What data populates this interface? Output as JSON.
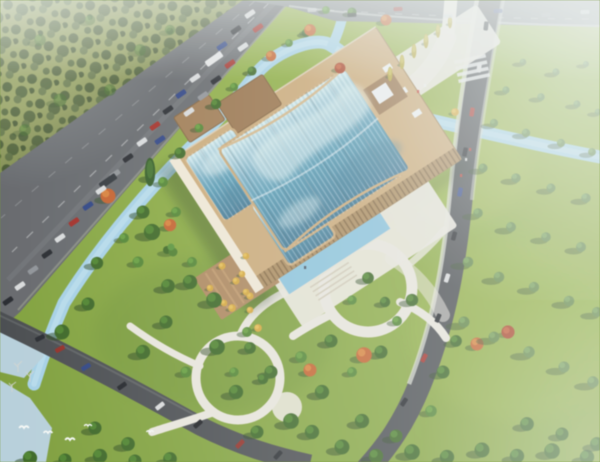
{
  "meta": {
    "type": "aerial-architectural-rendering",
    "subject": "Bird's-eye rendering of a cultural center with three curved glass vault roofs set in a landscaped riverside park",
    "time_of_day": "day",
    "season": "early autumn"
  },
  "palette": {
    "lawn": "#7a9a3a",
    "lawn_light": "#9ab64c",
    "forest_base": "#8f9b58",
    "forest_dot": "#46592f",
    "road": "#63666a",
    "road_dark": "#45484c",
    "road_haze": "#7e8386",
    "curb": "#9aa08f",
    "water": "#a6d0e4",
    "pond": "#b7cfd9",
    "pool": "#8cc2da",
    "path_light": "#e9e6dc",
    "plaza_tan": "#aa845c",
    "deck_brown": "#96714a",
    "frame_tan": "#c9a878",
    "wall_light": "#f0e8d6",
    "wall_shade": "#a98a5e",
    "glass_light": "#d6edf0",
    "glass_mid": "#7fb2c6",
    "glass_teal": "#579ab3",
    "glass_deep": "#3f7490",
    "tree_dark": "#386222",
    "tree_mid": "#4e8030",
    "tree_pale": "#5d8242",
    "autumn_orange": "#bf5f2c",
    "autumn_yellow": "#d2a53e",
    "autumn_red": "#a33d22",
    "car_white": "#d8dadb",
    "car_dark": "#23262b",
    "car_red": "#9c2b24",
    "car_blue": "#2b3f7e",
    "haze": "#eef3f2"
  },
  "scene": {
    "building": {
      "glass_halls": 3,
      "roof_style": "curved glass vaults with fine mullion stripes and wavy sky reflections",
      "frame": "tan stone podium with sunlit white west walls",
      "north_decks": "two brown entrance decks bridging the stream",
      "south": "reflecting pool, white plaza with steps, stepped tan terrace with small yellow trees"
    },
    "landscape": [
      "winding stream along highway and under right avenue",
      "white park paths with two circular loops and a round plaza",
      "lawns with scattered green trees and orange, red and yellow autumn accents",
      "row of tall yellow poplars by the north walkway",
      "lake with bare trees and flying white birds at lower left",
      "dense olive forest upper left",
      "open tree-dotted park on the right"
    ],
    "roads": {
      "upper_left": "wide multi-lane highway with dense car and truck traffic",
      "top": "hazy boulevard with light traffic",
      "right": "avenue with crosswalk, sidewalks and street traffic",
      "lower_left": "curved park road with cars"
    },
    "atmosphere": {
      "haze": "strong white haze at top-right corner, lighter at all edges",
      "focus": "soft overall blur, render-style"
    }
  }
}
